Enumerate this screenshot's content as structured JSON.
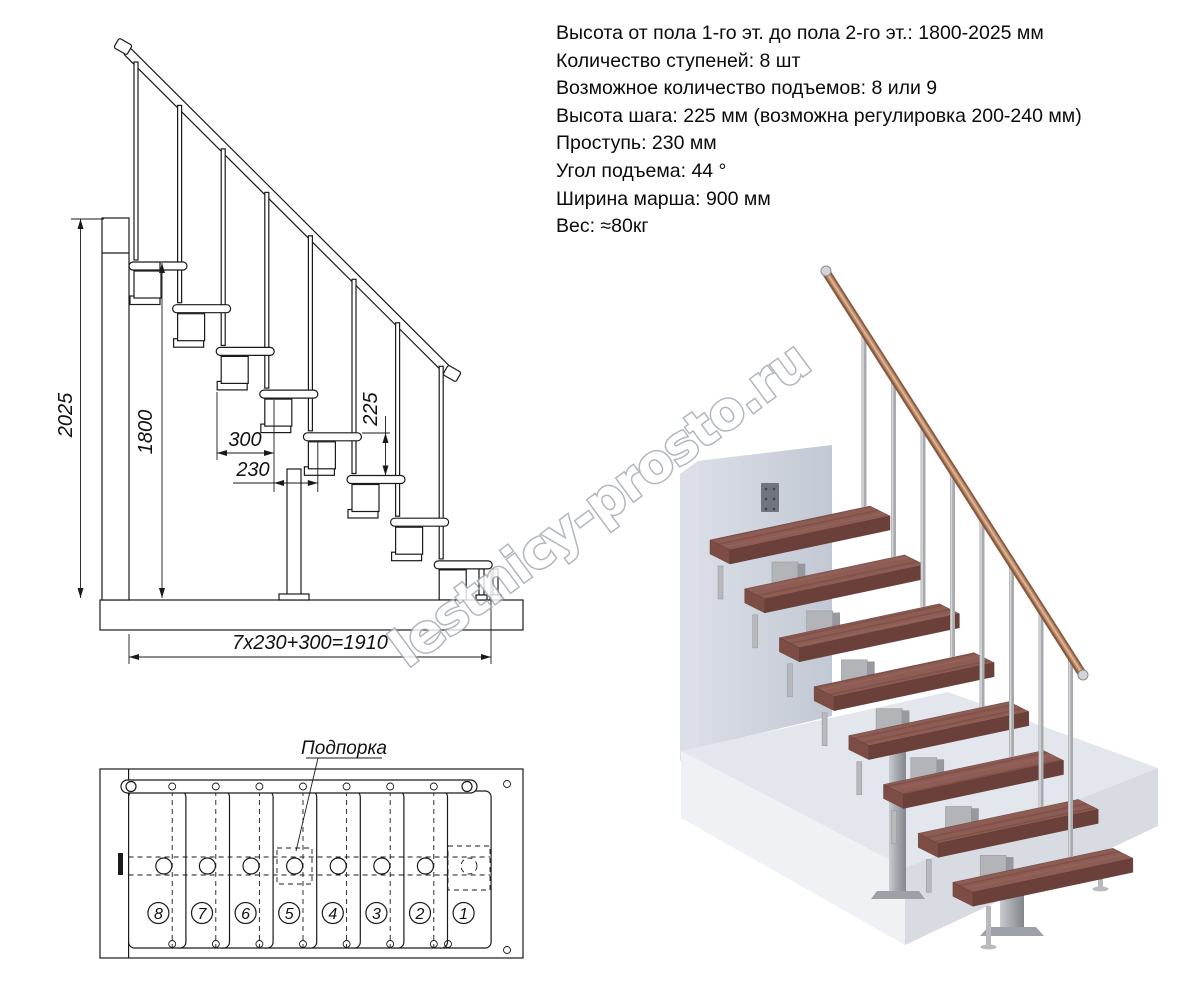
{
  "specs": {
    "lines": [
      "Высота от пола 1-го эт. до пола 2-го эт.: 1800-2025 мм",
      "Количество ступеней: 8 шт",
      "Возможное количество подъемов: 8 или 9",
      "Высота шага: 225 мм (возможна регулировка 200-240 мм)",
      "Проступь: 230 мм",
      "Угол подъема: 44 °",
      "Ширина марша: 900 мм",
      "Вес: ≈80кг"
    ]
  },
  "side_view": {
    "dims": {
      "total_height": "2025",
      "clear_height": "1800",
      "top_tread_depth": "300",
      "run": "230",
      "rise": "225",
      "total_run_formula": "7x230+300=1910"
    }
  },
  "plan": {
    "support_label": "Подпорка",
    "step_numbers": [
      "8",
      "7",
      "6",
      "5",
      "4",
      "3",
      "2",
      "1"
    ]
  },
  "watermark": {
    "text": "lestnicy-prosto.ru"
  },
  "colors": {
    "wood_top": "#8d5c54",
    "wood_front": "#6b403a",
    "metal": "#aaacb0",
    "handrail_wood": "#a9795f",
    "wall": "#ccd1dc",
    "floor": "#e3e6ec",
    "line": "#1a1a1a"
  }
}
